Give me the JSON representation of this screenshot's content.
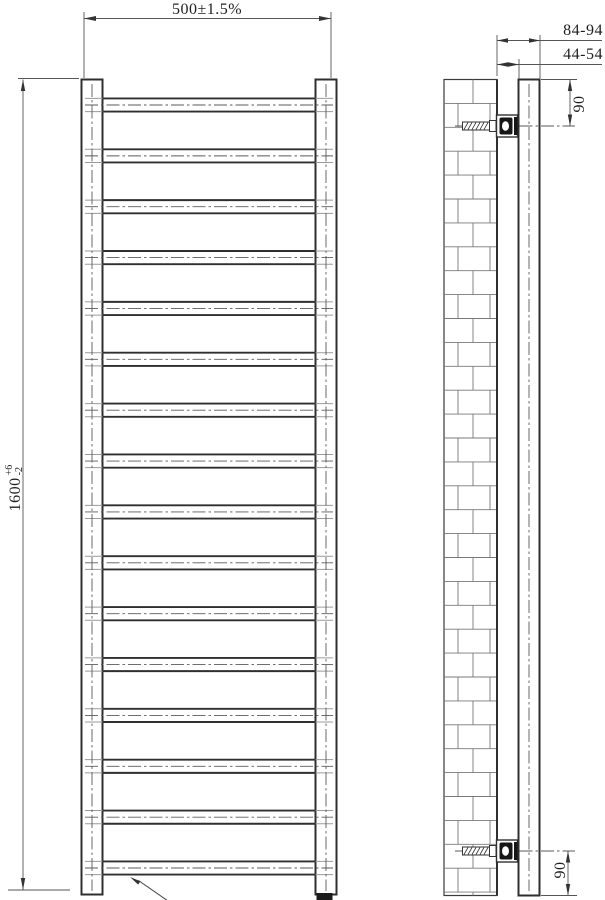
{
  "drawing": {
    "type": "technical-drawing",
    "subject": "ladder towel radiator - front view and wall-mount side view",
    "dimensions": {
      "width": "500±1.5%",
      "height": "1600",
      "height_tol_plus": "+6",
      "height_tol_minus": "-2",
      "wall_to_front": "84-94",
      "wall_to_back": "44-54",
      "bracket_offset_top": "90",
      "bracket_offset_bottom": "90"
    },
    "front_view": {
      "rung_count": 16
    },
    "colors": {
      "line": "#2f2f2f",
      "thin_line": "#555555",
      "centerline": "#5a5a5a",
      "background": "#ffffff"
    }
  },
  "geometry": {
    "rungs": {
      "count": 16,
      "first_center_y": 105,
      "spacing": 50.867,
      "half_height": 6.6,
      "inner_x1": 102.5,
      "inner_x2": 315.5,
      "outer_x1": 85,
      "outer_x2": 333
    },
    "wall": {
      "x": 444,
      "y": 79.5,
      "w": 53,
      "h": 816,
      "course_h": 23.9,
      "joints_even": [
        473
      ],
      "joints_odd": [
        458,
        490
      ]
    },
    "brackets": {
      "centers_y": [
        126,
        851
      ]
    }
  }
}
